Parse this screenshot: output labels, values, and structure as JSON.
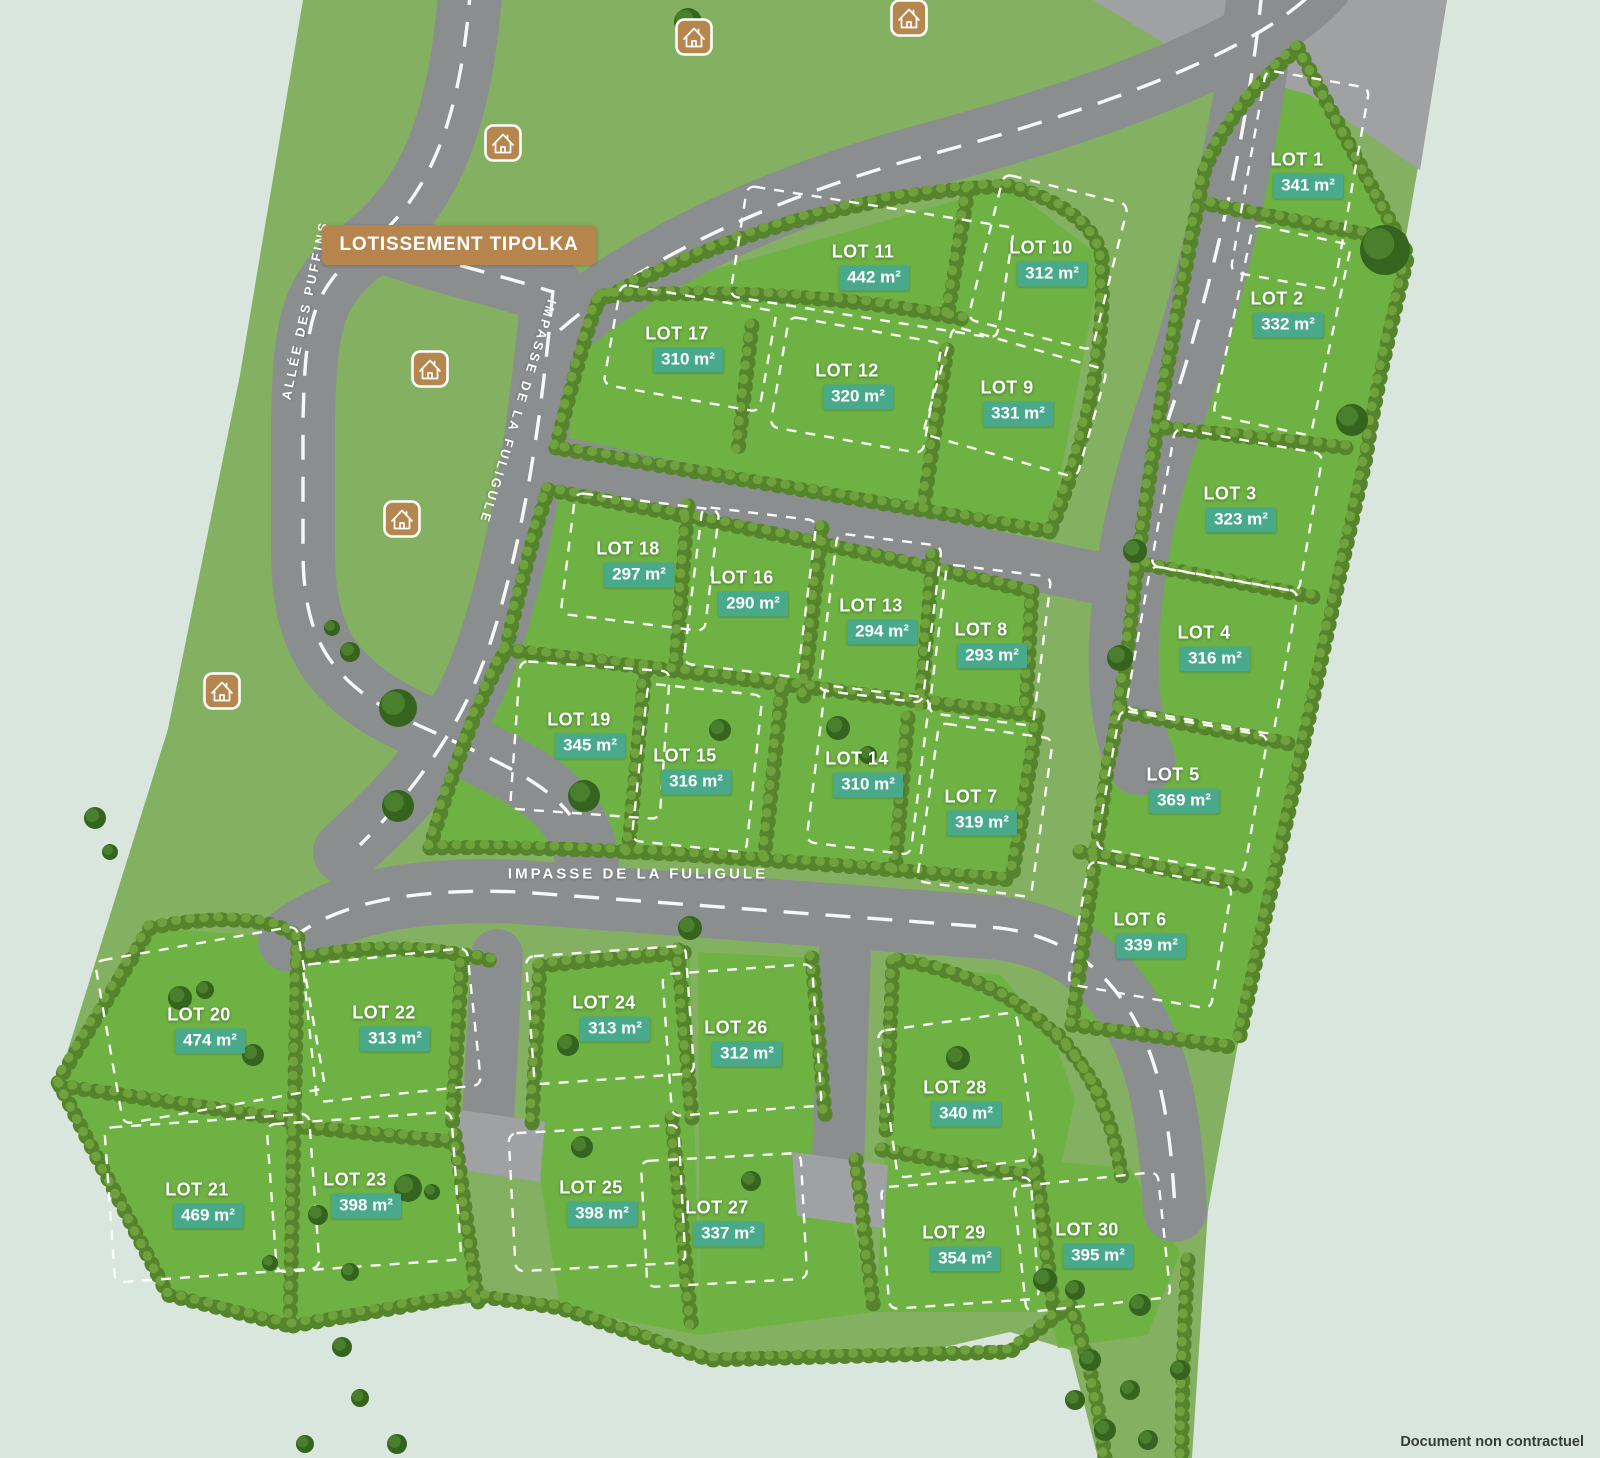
{
  "map": {
    "title": "LOTISSEMENT TIPOLKA",
    "footer_note": "Document non contractuel",
    "area_unit": "m²",
    "streets": [
      {
        "id": "allee-des-puffins",
        "name": "ALLÉE DES PUFFINS"
      },
      {
        "id": "impasse-de-la-fuligule-diagonal",
        "name": "IMPASSE DE LA FULIGULE"
      },
      {
        "id": "impasse-de-la-fuligule-horizontal",
        "name": "IMPASSE DE LA FULIGULE"
      }
    ],
    "colors": {
      "background_mint": "#d9e6dd",
      "field_green": "#83b161",
      "lot_green": "#6fb244",
      "hedge_green": "#55842d",
      "road_gray": "#8b8e8f",
      "area_badge_teal": "#48a98b",
      "title_banner_brown": "#b5854d",
      "house_icon_brown": "#b5874e",
      "dash_white": "#ffffff",
      "footer_text": "#353d37"
    },
    "house_icons": [
      {
        "x": 694,
        "y": 37
      },
      {
        "x": 909,
        "y": 18
      },
      {
        "x": 503,
        "y": 143
      },
      {
        "x": 430,
        "y": 369
      },
      {
        "x": 402,
        "y": 519
      },
      {
        "x": 222,
        "y": 691
      }
    ],
    "lots": [
      {
        "name": "LOT 1",
        "area_m2": 341,
        "x": 1297,
        "y": 162,
        "outline": {
          "cx": 1300,
          "cy": 180,
          "w": 105,
          "h": 205,
          "angle": 10
        }
      },
      {
        "name": "LOT 2",
        "area_m2": 332,
        "x": 1277,
        "y": 301,
        "outline": {
          "cx": 1282,
          "cy": 330,
          "w": 100,
          "h": 195,
          "angle": 12
        }
      },
      {
        "name": "LOT 3",
        "area_m2": 323,
        "x": 1230,
        "y": 496,
        "outline": {
          "cx": 1237,
          "cy": 510,
          "w": 150,
          "h": 140,
          "angle": 10
        }
      },
      {
        "name": "LOT 4",
        "area_m2": 316,
        "x": 1204,
        "y": 635,
        "outline": {
          "cx": 1212,
          "cy": 650,
          "w": 150,
          "h": 145,
          "angle": 10
        }
      },
      {
        "name": "LOT 5",
        "area_m2": 369,
        "x": 1173,
        "y": 777,
        "outline": {
          "cx": 1182,
          "cy": 792,
          "w": 150,
          "h": 140,
          "angle": 10
        }
      },
      {
        "name": "LOT 6",
        "area_m2": 339,
        "x": 1140,
        "y": 922,
        "outline": {
          "cx": 1150,
          "cy": 935,
          "w": 145,
          "h": 125,
          "angle": 10
        }
      },
      {
        "name": "LOT 7",
        "area_m2": 319,
        "x": 971,
        "y": 799,
        "outline": {
          "cx": 985,
          "cy": 810,
          "w": 115,
          "h": 160,
          "angle": 8
        }
      },
      {
        "name": "LOT 8",
        "area_m2": 293,
        "x": 981,
        "y": 632,
        "outline": {
          "cx": 990,
          "cy": 645,
          "w": 105,
          "h": 150,
          "angle": 7
        }
      },
      {
        "name": "LOT 9",
        "area_m2": 331,
        "x": 1007,
        "y": 390,
        "outline": {
          "cx": 1015,
          "cy": 402,
          "w": 160,
          "h": 112,
          "angle": 16
        }
      },
      {
        "name": "LOT 10",
        "area_m2": 312,
        "x": 1041,
        "y": 250,
        "outline": {
          "cx": 1048,
          "cy": 262,
          "w": 128,
          "h": 150,
          "angle": 14
        }
      },
      {
        "name": "LOT 11",
        "area_m2": 442,
        "x": 863,
        "y": 254,
        "outline": {
          "cx": 872,
          "cy": 262,
          "w": 270,
          "h": 112,
          "angle": 9
        }
      },
      {
        "name": "LOT 12",
        "area_m2": 320,
        "x": 847,
        "y": 373,
        "outline": {
          "cx": 856,
          "cy": 385,
          "w": 155,
          "h": 112,
          "angle": 10
        }
      },
      {
        "name": "LOT 13",
        "area_m2": 294,
        "x": 871,
        "y": 608,
        "outline": {
          "cx": 880,
          "cy": 618,
          "w": 105,
          "h": 158,
          "angle": 7
        }
      },
      {
        "name": "LOT 14",
        "area_m2": 310,
        "x": 857,
        "y": 761,
        "outline": {
          "cx": 868,
          "cy": 770,
          "w": 105,
          "h": 158,
          "angle": 7
        }
      },
      {
        "name": "LOT 15",
        "area_m2": 316,
        "x": 685,
        "y": 758,
        "outline": {
          "cx": 697,
          "cy": 768,
          "w": 115,
          "h": 158,
          "angle": 6
        }
      },
      {
        "name": "LOT 16",
        "area_m2": 290,
        "x": 742,
        "y": 580,
        "outline": {
          "cx": 750,
          "cy": 592,
          "w": 115,
          "h": 158,
          "angle": 7
        }
      },
      {
        "name": "LOT 17",
        "area_m2": 310,
        "x": 677,
        "y": 336,
        "outline": {
          "cx": 690,
          "cy": 348,
          "w": 158,
          "h": 102,
          "angle": 10
        }
      },
      {
        "name": "LOT 18",
        "area_m2": 297,
        "x": 628,
        "y": 551,
        "outline": {
          "cx": 640,
          "cy": 562,
          "w": 145,
          "h": 122,
          "angle": 7
        }
      },
      {
        "name": "LOT 19",
        "area_m2": 345,
        "x": 579,
        "y": 722,
        "outline": {
          "cx": 590,
          "cy": 740,
          "w": 150,
          "h": 148,
          "angle": 4
        }
      },
      {
        "name": "LOT 20",
        "area_m2": 474,
        "x": 199,
        "y": 1017,
        "outline": {
          "cx": 210,
          "cy": 1025,
          "w": 205,
          "h": 165,
          "angle": -10
        }
      },
      {
        "name": "LOT 21",
        "area_m2": 469,
        "x": 197,
        "y": 1192,
        "outline": {
          "cx": 212,
          "cy": 1198,
          "w": 205,
          "h": 155,
          "angle": -4
        }
      },
      {
        "name": "LOT 22",
        "area_m2": 313,
        "x": 384,
        "y": 1015,
        "outline": {
          "cx": 392,
          "cy": 1025,
          "w": 165,
          "h": 138,
          "angle": -6
        }
      },
      {
        "name": "LOT 23",
        "area_m2": 398,
        "x": 355,
        "y": 1182,
        "outline": {
          "cx": 364,
          "cy": 1192,
          "w": 185,
          "h": 148,
          "angle": -4
        }
      },
      {
        "name": "LOT 24",
        "area_m2": 313,
        "x": 604,
        "y": 1005,
        "outline": {
          "cx": 610,
          "cy": 1015,
          "w": 160,
          "h": 128,
          "angle": -4
        }
      },
      {
        "name": "LOT 25",
        "area_m2": 398,
        "x": 591,
        "y": 1190,
        "outline": {
          "cx": 597,
          "cy": 1198,
          "w": 170,
          "h": 138,
          "angle": -3
        }
      },
      {
        "name": "LOT 26",
        "area_m2": 312,
        "x": 736,
        "y": 1030,
        "outline": {
          "cx": 742,
          "cy": 1040,
          "w": 150,
          "h": 142,
          "angle": -4
        }
      },
      {
        "name": "LOT 27",
        "area_m2": 337,
        "x": 717,
        "y": 1210,
        "outline": {
          "cx": 724,
          "cy": 1220,
          "w": 160,
          "h": 126,
          "angle": -3
        }
      },
      {
        "name": "LOT 28",
        "area_m2": 340,
        "x": 955,
        "y": 1090,
        "outline": {
          "cx": 957,
          "cy": 1095,
          "w": 140,
          "h": 148,
          "angle": -8
        }
      },
      {
        "name": "LOT 29",
        "area_m2": 354,
        "x": 954,
        "y": 1235,
        "outline": {
          "cx": 960,
          "cy": 1243,
          "w": 150,
          "h": 122,
          "angle": -4
        }
      },
      {
        "name": "LOT 30",
        "area_m2": 395,
        "x": 1087,
        "y": 1232,
        "outline": {
          "cx": 1092,
          "cy": 1242,
          "w": 145,
          "h": 126,
          "angle": -6
        }
      }
    ]
  }
}
